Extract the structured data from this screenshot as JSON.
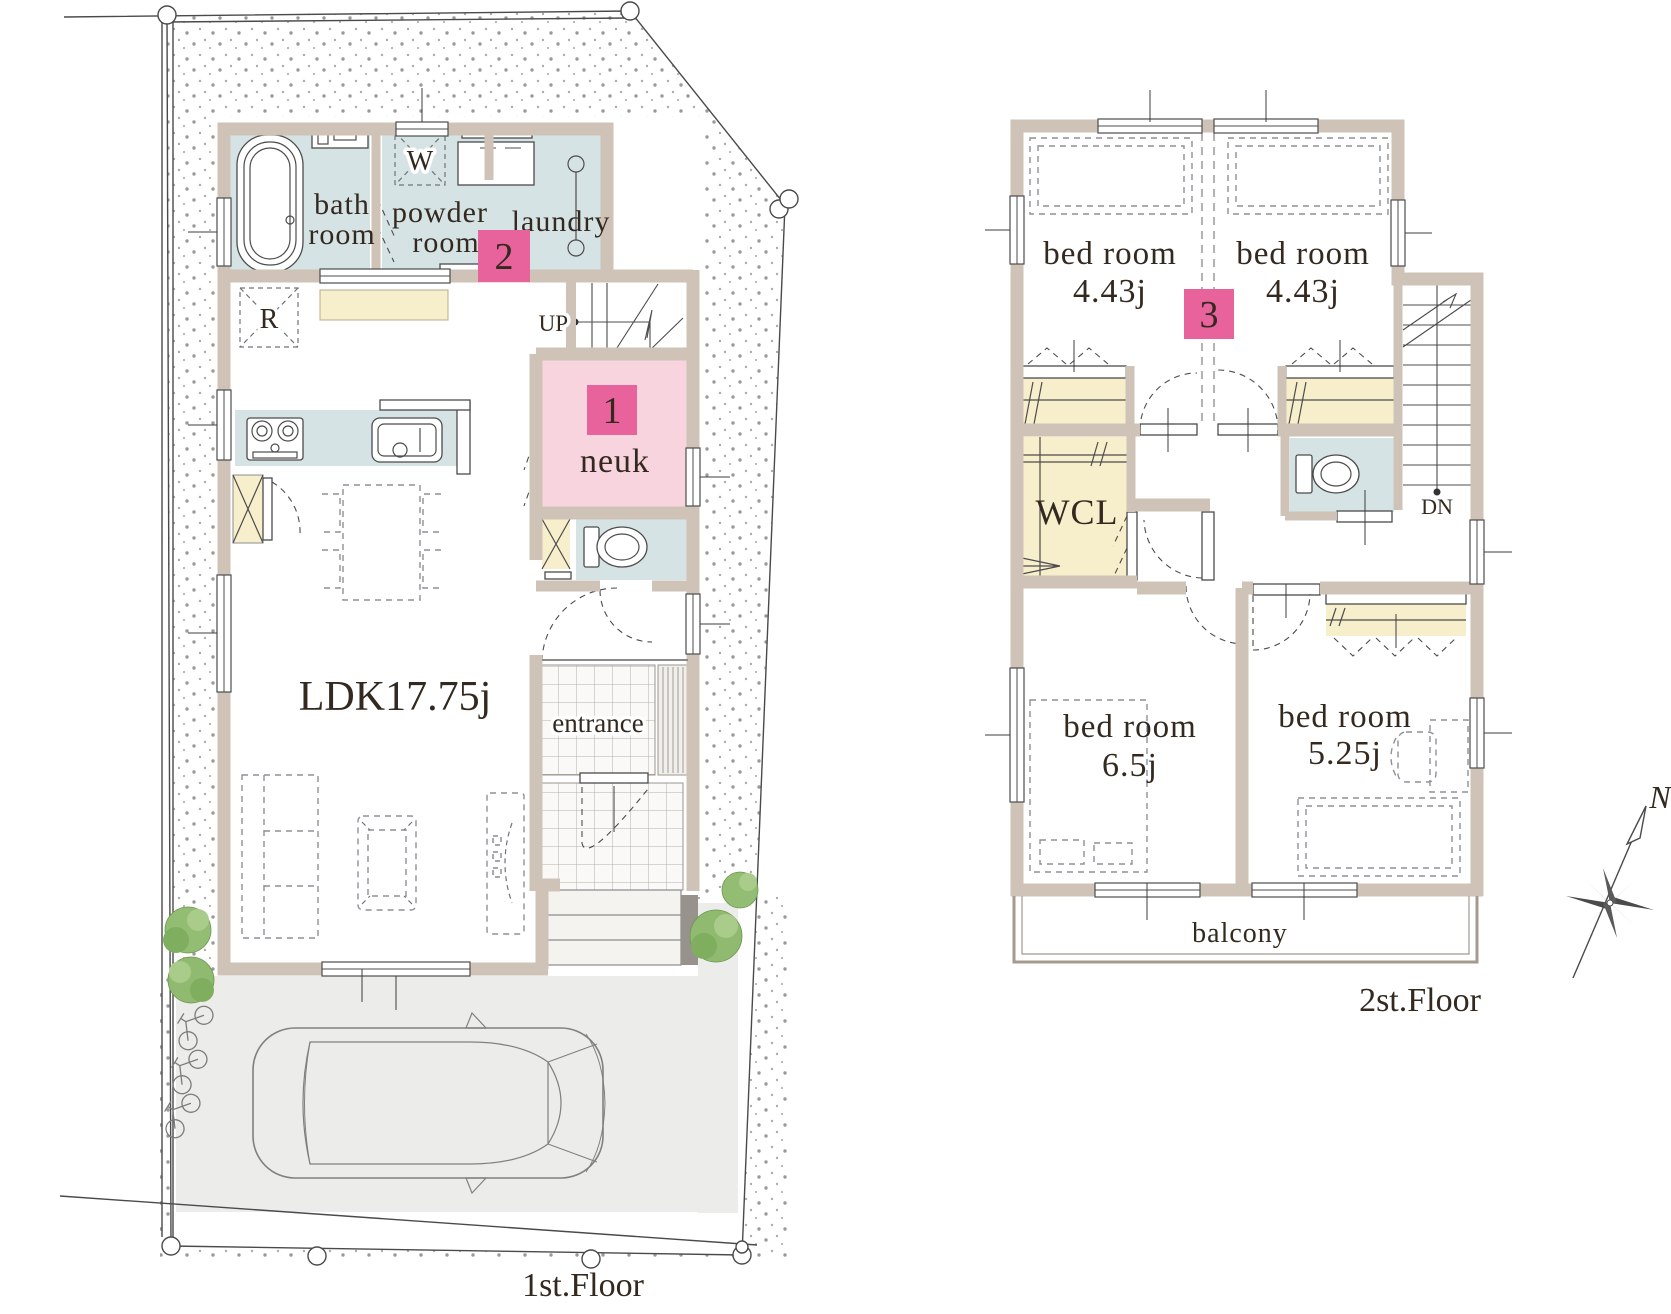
{
  "colors": {
    "wall": "#cfc3b8",
    "wet_room": "#d6e3e5",
    "accent_room": "#f8d5de",
    "closet": "#f7eecb",
    "badge": "#e8639b",
    "badge_text": "#ffffff",
    "driveway": "#ececea",
    "pillar": "#98928c",
    "steps": "#f4f3f0",
    "tree": "#8fba6f"
  },
  "floor1": {
    "caption": "1st.Floor",
    "rooms": {
      "bath": {
        "line1": "bath",
        "line2": "room"
      },
      "powder": {
        "line1": "powder",
        "line2": "room"
      },
      "laundry": "laundry",
      "neuk": "neuk",
      "ldk": "LDK17.75j",
      "entrance": "entrance"
    },
    "marks": {
      "washer": "W",
      "fridge": "R",
      "up": "UP"
    },
    "badges": {
      "neuk": "1",
      "powder": "2"
    }
  },
  "floor2": {
    "caption": "2st.Floor",
    "rooms": {
      "bedroom1": {
        "name": "bed room",
        "size": "4.43j"
      },
      "bedroom2": {
        "name": "bed room",
        "size": "4.43j"
      },
      "bedroom3": {
        "name": "bed room",
        "size": "6.5j"
      },
      "bedroom4": {
        "name": "bed room",
        "size": "5.25j"
      },
      "wcl": "WCL",
      "balcony": "balcony"
    },
    "marks": {
      "down": "DN"
    },
    "badges": {
      "hall": "3"
    }
  },
  "compass": {
    "north": "N"
  }
}
